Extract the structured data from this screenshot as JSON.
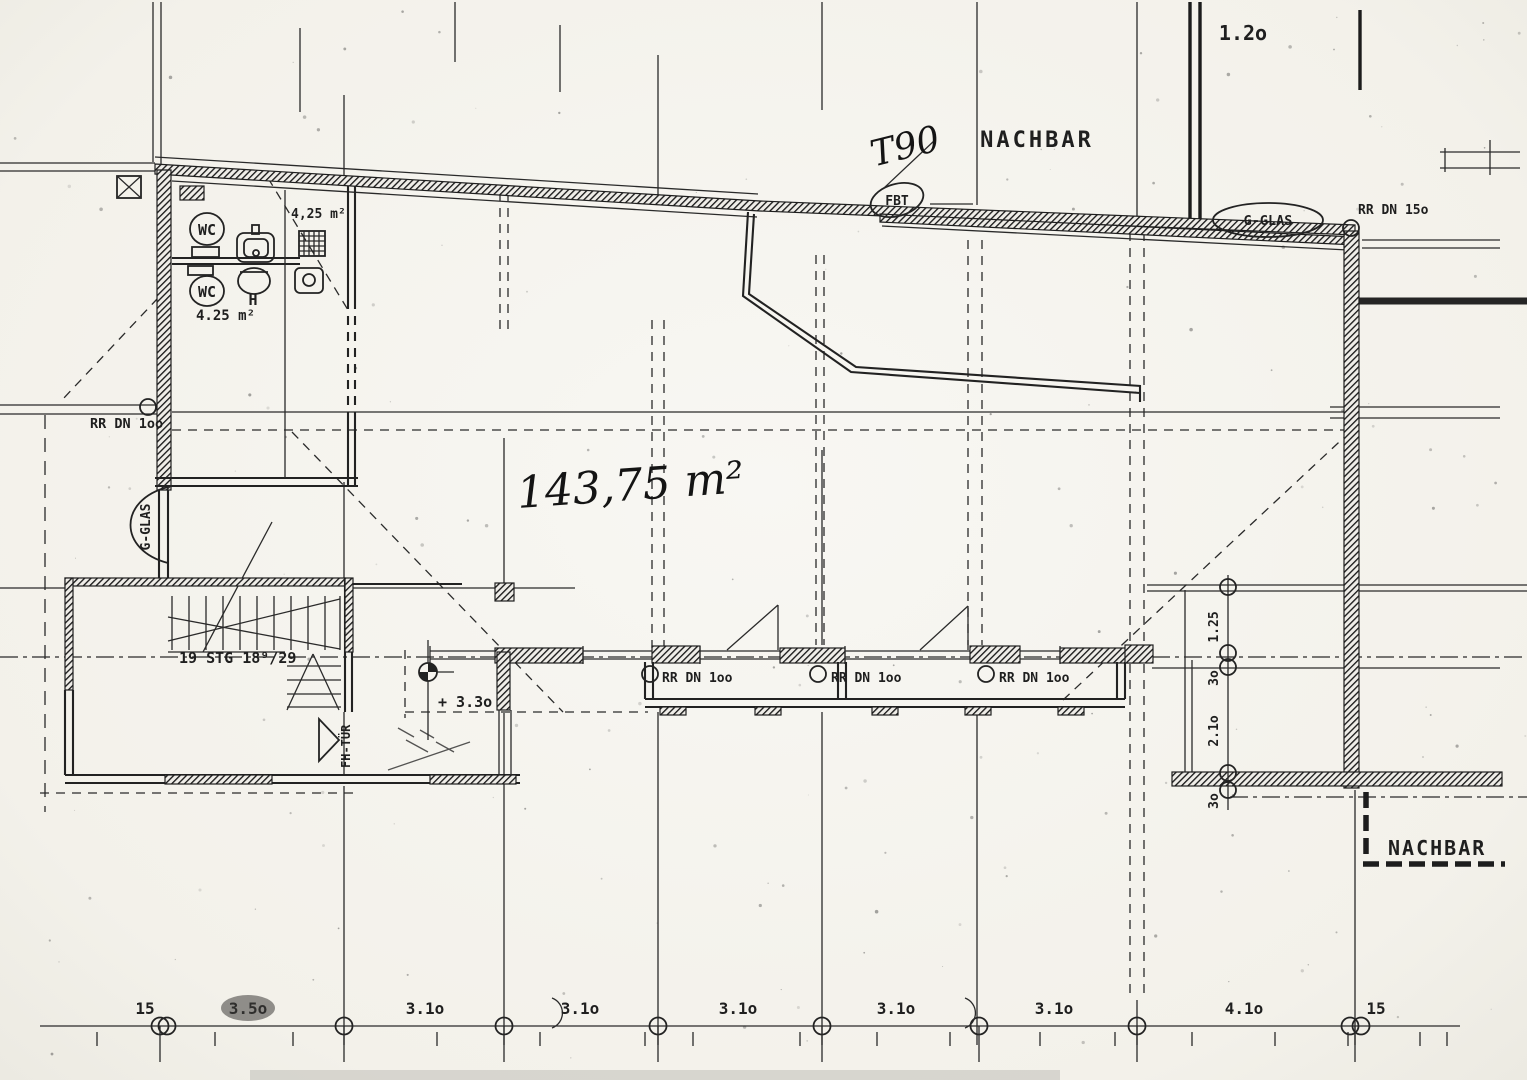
{
  "labels": {
    "nachbar_top": "NACHBAR",
    "nachbar_bottom": "NACHBAR",
    "top_gap_dim": "1.2o",
    "fire_rating": "T90",
    "floor_drain_tag": "FBT",
    "glass_top": "G-GLAS",
    "glass_left": "G-GLAS",
    "roof_drain_150": "RR DN 15o",
    "roof_drain_100_left": "RR DN 1oo",
    "roof_drain_100_a": "RR DN 1oo",
    "roof_drain_100_b": "RR DN 1oo",
    "roof_drain_100_c": "RR DN 1oo",
    "hall_area": "143,75 m²",
    "wc_upper": "WC",
    "wc_upper_area": "4,25 m²",
    "wc_lower": "WC",
    "wc_lower_area": "4.25 m²",
    "basin_tag": "H",
    "stair_note": "19 STG 18⁹/29",
    "level_mark": "+ 3.3o",
    "door_tag": "FH-TÜR"
  },
  "dimensions": {
    "bottom": [
      "15",
      "3.5o",
      "3.1o",
      "3.1o",
      "3.1o",
      "3.1o",
      "3.1o",
      "4.1o",
      "15"
    ],
    "right": [
      "1.25",
      "3o",
      "2.1o",
      "3o"
    ]
  }
}
